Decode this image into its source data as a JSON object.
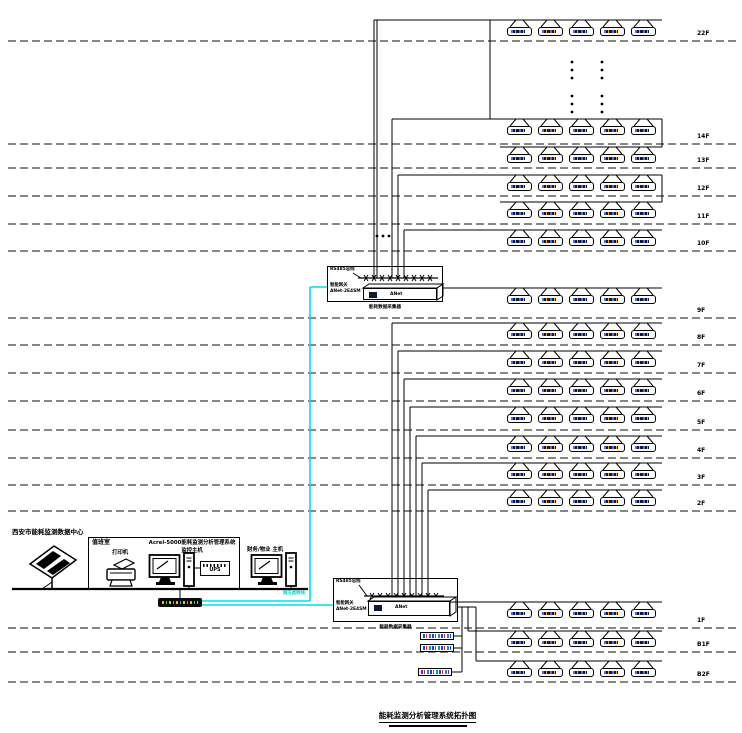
{
  "title": "能耗监测分析管理系统拓扑图",
  "data_center_label": "西安市能耗监测数据中心",
  "duty_room": {
    "name": "值班室",
    "printer_label": "打印机",
    "host_label_line1": "Acrel-5000能耗监测分析管理系统",
    "host_label_line2": "监控主机",
    "ups_label": "UPS"
  },
  "finance_host_label": "财务/物业  主机",
  "lan_cable_label": "超五类网线",
  "collectors": [
    {
      "bus_label": "RS485总线",
      "gateway_label_line1": "智能网关",
      "gateway_label_line2": "ANet-2E4SM",
      "device_text": "ANet",
      "caption": "能耗数据采集器"
    },
    {
      "bus_label": "RS485总线",
      "gateway_label_line1": "智能网关",
      "gateway_label_line2": "ANet-2E4SM",
      "device_text": "ANet",
      "caption": "能耗数据采集器"
    }
  ],
  "floors": [
    {
      "label": "22F"
    },
    {
      "label": "14F"
    },
    {
      "label": "13F"
    },
    {
      "label": "12F"
    },
    {
      "label": "11F"
    },
    {
      "label": "10F"
    },
    {
      "label": "9F"
    },
    {
      "label": "8F"
    },
    {
      "label": "7F"
    },
    {
      "label": "6F"
    },
    {
      "label": "5F"
    },
    {
      "label": "4F"
    },
    {
      "label": "3F"
    },
    {
      "label": "2F"
    },
    {
      "label": "1F"
    },
    {
      "label": "B1F"
    },
    {
      "label": "B2F"
    }
  ],
  "colors": {
    "wire": "#000000",
    "separator": "#3d3d3d",
    "network_cyan": "#00e0e0",
    "display_panel": "#101a33"
  }
}
